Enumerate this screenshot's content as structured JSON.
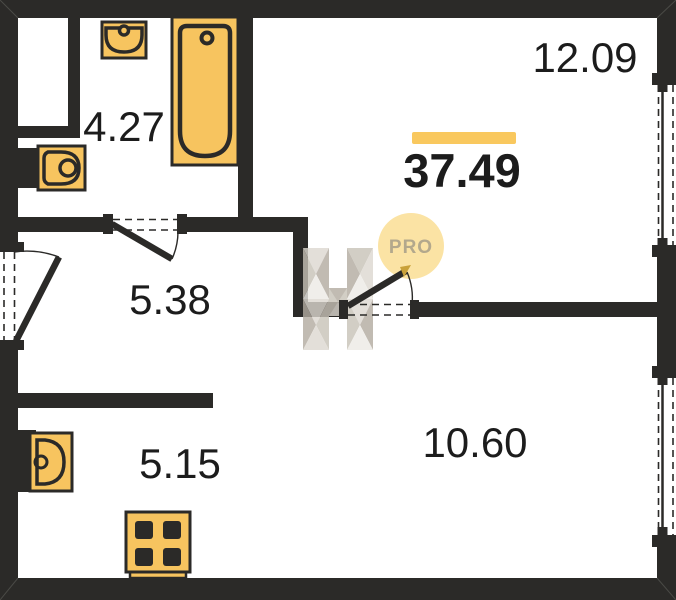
{
  "plan": {
    "total_area": "37.49",
    "badge": "PRO",
    "rooms": {
      "living": "12.09",
      "bathroom": "4.27",
      "hall": "5.38",
      "kitchen": "5.15",
      "bedroom": "10.60"
    }
  },
  "colors": {
    "wall": "#2b2a28",
    "fixture": "#f7c45f",
    "accent": "#f9c85e",
    "label": "#1c1c1c",
    "badge_bg": "#fbe3a4",
    "badge_text": "#b3a88c",
    "door_tip": "#c9a13b",
    "wm_xlight": "#edebe6",
    "wm_light": "#ddd8d0",
    "wm_mid": "#c8c2b7",
    "wm_dark": "#b2aba0"
  }
}
